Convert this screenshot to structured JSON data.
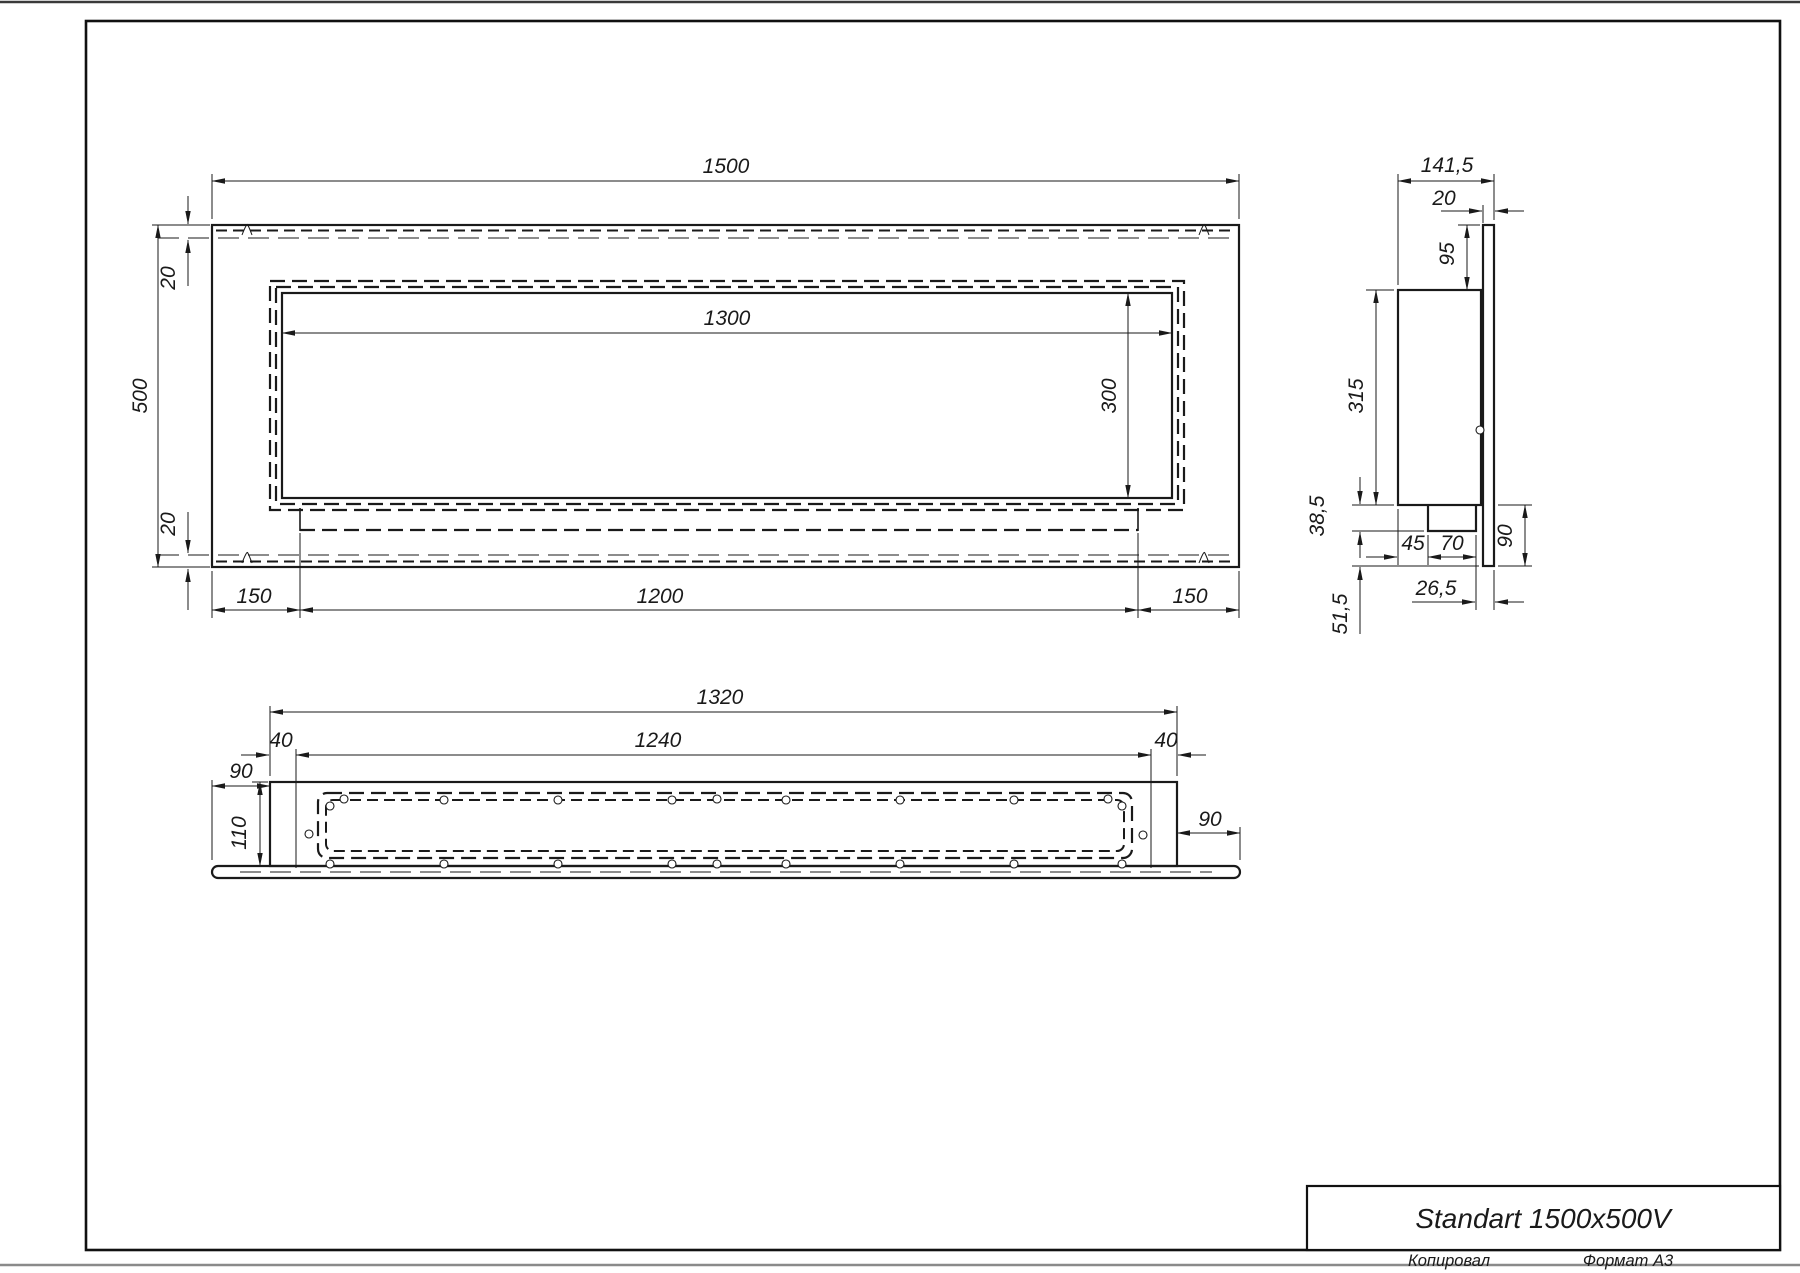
{
  "colors": {
    "line": "#1a1a1a",
    "paper": "#ffffff"
  },
  "title_block": {
    "title": "Standart 1500x500V"
  },
  "footer": {
    "copied_label": "Копировал",
    "format_label": "Формат А3"
  },
  "front_view": {
    "width": "1500",
    "height": "500",
    "top_band": "20",
    "bottom_band": "20",
    "opening_width": "1300",
    "opening_height": "300",
    "left_offset": "150",
    "burner_length": "1200",
    "right_offset": "150"
  },
  "side_view": {
    "overall_depth": "141,5",
    "panel_thickness": "20",
    "top_offset": "95",
    "body_depth": "315",
    "bracket_drop": "38,5",
    "bracket_offset": "45",
    "bracket_width": "70",
    "flange_height": "90",
    "panel_gap": "26,5",
    "lower_drop": "51,5"
  },
  "bottom_view": {
    "body_width": "1320",
    "mount_width": "1240",
    "left_inset": "40",
    "right_inset": "40",
    "left_flange": "90",
    "right_flange": "90",
    "depth": "110"
  }
}
